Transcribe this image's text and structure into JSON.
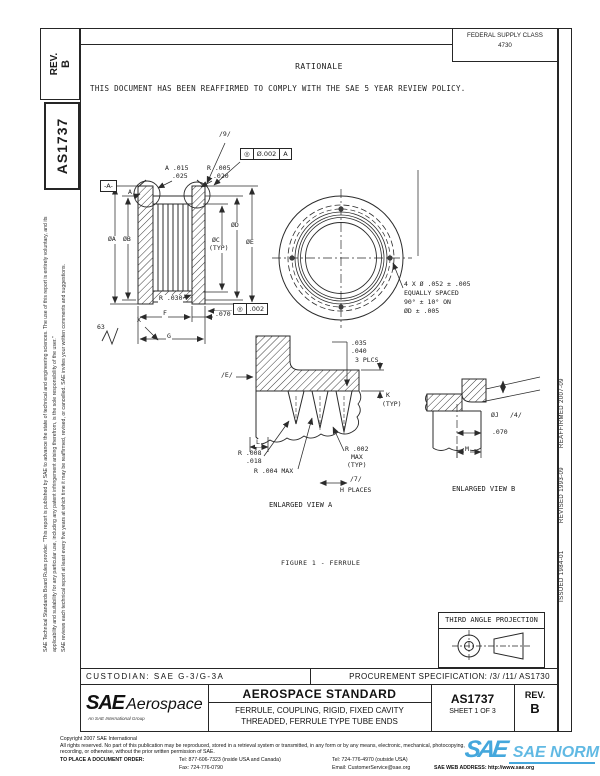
{
  "doc": {
    "rev_label": "REV.",
    "rev_value": "B",
    "number": "AS1737",
    "fsc_label": "FEDERAL SUPPLY CLASS",
    "fsc_value": "4730",
    "rationale_title": "RATIONALE",
    "rationale_text": "THIS DOCUMENT HAS BEEN REAFFIRMED TO COMPLY WITH THE SAE 5 YEAR REVIEW POLICY."
  },
  "margins": {
    "left_para1": "SAE Technical Standards Board Rules provide: \"This report is published by SAE to advance the state of technical and engineering sciences. The use of this report is entirely voluntary, and its applicability and suitability for any particular use, including any patent infringement arising therefrom, is the sole responsibility of the user.\"",
    "left_para2": "SAE reviews each technical report at least every five years at which time it may be reaffirmed, revised, or cancelled. SAE invites your written comments and suggestions.",
    "issued": "ISSUED 1984-01",
    "revised": "REVISED 1993-09",
    "reaffirmed": "REAFFIRMED 2007-09"
  },
  "drawing": {
    "section": {
      "datum_flag": "-A-",
      "view_marker": "A",
      "chamfer1": "A .015",
      "chamfer2": ".025",
      "radius1": "R .005",
      "radius2": ".020",
      "flag9": "/9/",
      "fcf_top_sym": "◎",
      "fcf_top_tol": "Ø.002",
      "fcf_top_datum": "A",
      "dia_a": "ØA",
      "dia_b": "ØB",
      "dia_c": "ØC",
      "dia_c_typ": "(TYP)",
      "dia_d": "ØD",
      "dia_e": "ØE",
      "r030": "R .030",
      "dim_f": "F",
      "dim_070": ".070",
      "fcf_bot_sym": "◎",
      "fcf_bot_tol": ".002",
      "finish": "63",
      "dim_x": "X",
      "dim_g": "G"
    },
    "front": {
      "note1": "4 X Ø .052 ± .005",
      "note2": "EQUALLY SPACED",
      "note3": "90° ± 10° ON",
      "note4": "ØD ± .005"
    },
    "view_a": {
      "flag_e": "/E/",
      "d1": ".035",
      "d2": ".040",
      "d3": "3 PLCS",
      "k": "K",
      "k_typ": "(TYP)",
      "l": "L",
      "r1a": "R .008",
      "r1b": ".018",
      "r2": "R .004 MAX",
      "r3a": "R .002",
      "r3b": "MAX",
      "r3c": "(TYP)",
      "flag7": "/7/",
      "places": "H PLACES",
      "caption": "ENLARGED VIEW A"
    },
    "view_b": {
      "dia_j": "ØJ",
      "flag4": "/4/",
      "d070": ".070",
      "m": "M",
      "caption": "ENLARGED VIEW B"
    },
    "figure_caption": "FIGURE 1 - FERRULE",
    "projection": "THIRD ANGLE PROJECTION"
  },
  "title_block": {
    "custodian": "CUSTODIAN: SAE G-3/G-3A",
    "procurement": "PROCUREMENT SPECIFICATION: /3/ /11/ AS1730",
    "logo_main": "SAE",
    "logo_sub": "Aerospace",
    "logo_tag": "An SAE International Group",
    "kind": "AEROSPACE STANDARD",
    "title1": "FERRULE, COUPLING, RIGID, FIXED CAVITY",
    "title2": "THREADED, FERRULE TYPE TUBE ENDS",
    "number": "AS1737",
    "sheet": "SHEET 1 OF 3",
    "rev_label": "REV.",
    "rev_value": "B"
  },
  "footer": {
    "copyright": "Copyright 2007 SAE International",
    "rights1": "All rights reserved. No part of this publication may be reproduced, stored in a retrieval system or transmitted, in any form or by any means, electronic, mechanical, photocopying,",
    "rights2": "recording, or otherwise, without the prior written permission of SAE.",
    "order": "TO PLACE A DOCUMENT ORDER:",
    "tel1": "Tel: 877-606-7323 (inside USA and Canada)",
    "tel2": "Tel: 724-776-4970 (outside USA)",
    "fax": "Fax: 724-776-0790",
    "email": "Email: CustomerService@sae.org",
    "web": "SAE WEB ADDRESS: http://www.sae.org"
  },
  "watermark": {
    "logo": "SAE",
    "text": "SAE NORM",
    "color": "#35a3da"
  }
}
